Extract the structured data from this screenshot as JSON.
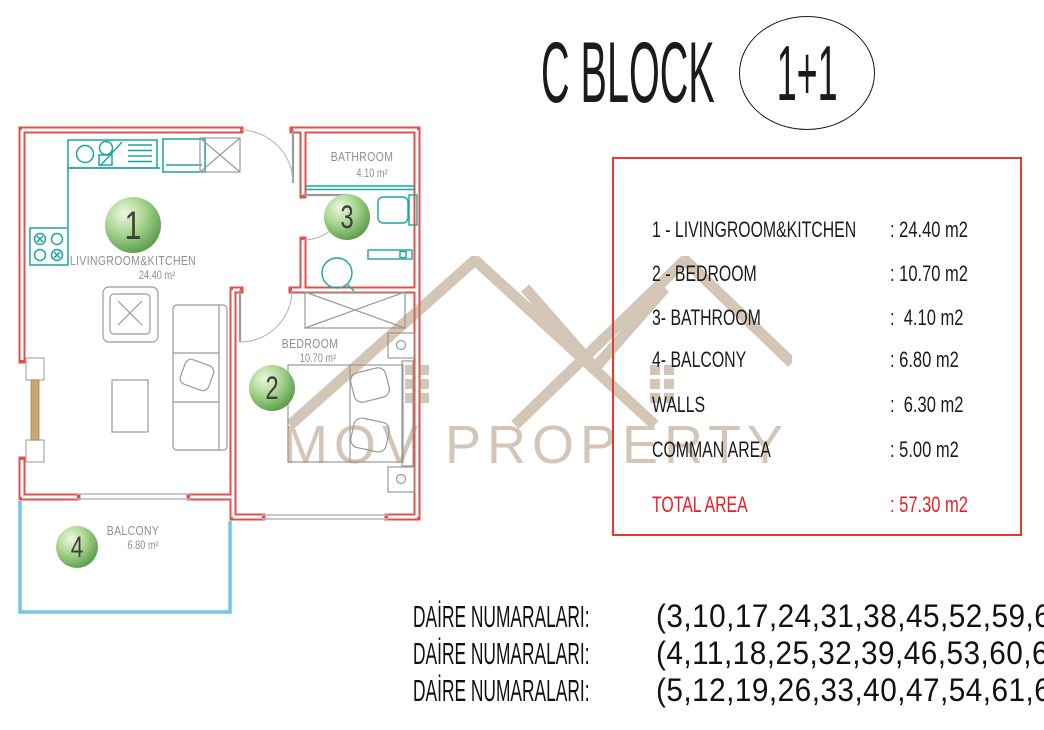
{
  "title": {
    "block_name": "C BLOCK",
    "unit_type": "1+1"
  },
  "floor_plan": {
    "rooms": [
      {
        "number": "1",
        "name": "LIVINGROOM&KITCHEN",
        "area": "24.40 m²"
      },
      {
        "number": "2",
        "name": "BEDROOM",
        "area": "10.70 m²"
      },
      {
        "number": "3",
        "name": "BATHROOM",
        "area": "4.10 m²"
      },
      {
        "number": "4",
        "name": "BALCONY",
        "area": "6.80 m²"
      }
    ]
  },
  "area_table": {
    "rows": [
      {
        "label": "1 - LIVINGROOM&KITCHEN",
        "value": ": 24.40 m2"
      },
      {
        "label": "2 - BEDROOM",
        "value": ": 10.70 m2"
      },
      {
        "label": "3- BATHROOM",
        "value": ":  4.10 m2"
      },
      {
        "label": "4- BALCONY",
        "value": ": 6.80 m2"
      },
      {
        "label": "WALLS",
        "value": ":  6.30 m2"
      },
      {
        "label": "COMMAN AREA",
        "value": ": 5.00 m2"
      }
    ],
    "total_row": {
      "label": "TOTAL AREA",
      "value": ": 57.30 m2"
    }
  },
  "watermark": {
    "text": "MOV PROPERTY"
  },
  "apartment_numbers": {
    "lines": [
      {
        "label": "DAİRE NUMARALARI:",
        "numbers": "(3,10,17,24,31,38,45,52,59,66)"
      },
      {
        "label": "DAİRE NUMARALARI:",
        "numbers": "(4,11,18,25,32,39,46,53,60,67)"
      },
      {
        "label": "DAİRE NUMARALARI:",
        "numbers": "(5,12,19,26,33,40,47,54,61,68)"
      }
    ]
  },
  "colors": {
    "wall_red": "#e0504c",
    "fixture_teal": "#1aa5a0",
    "balcony_blue": "#74c6e8",
    "circle_green": "#4e9440",
    "table_border_red": "#e43a30",
    "total_red": "#ec1c24",
    "watermark_tan": "#d2c2ae",
    "furniture_gray": "#9a9a9a",
    "label_gray": "#8f8f8f"
  }
}
